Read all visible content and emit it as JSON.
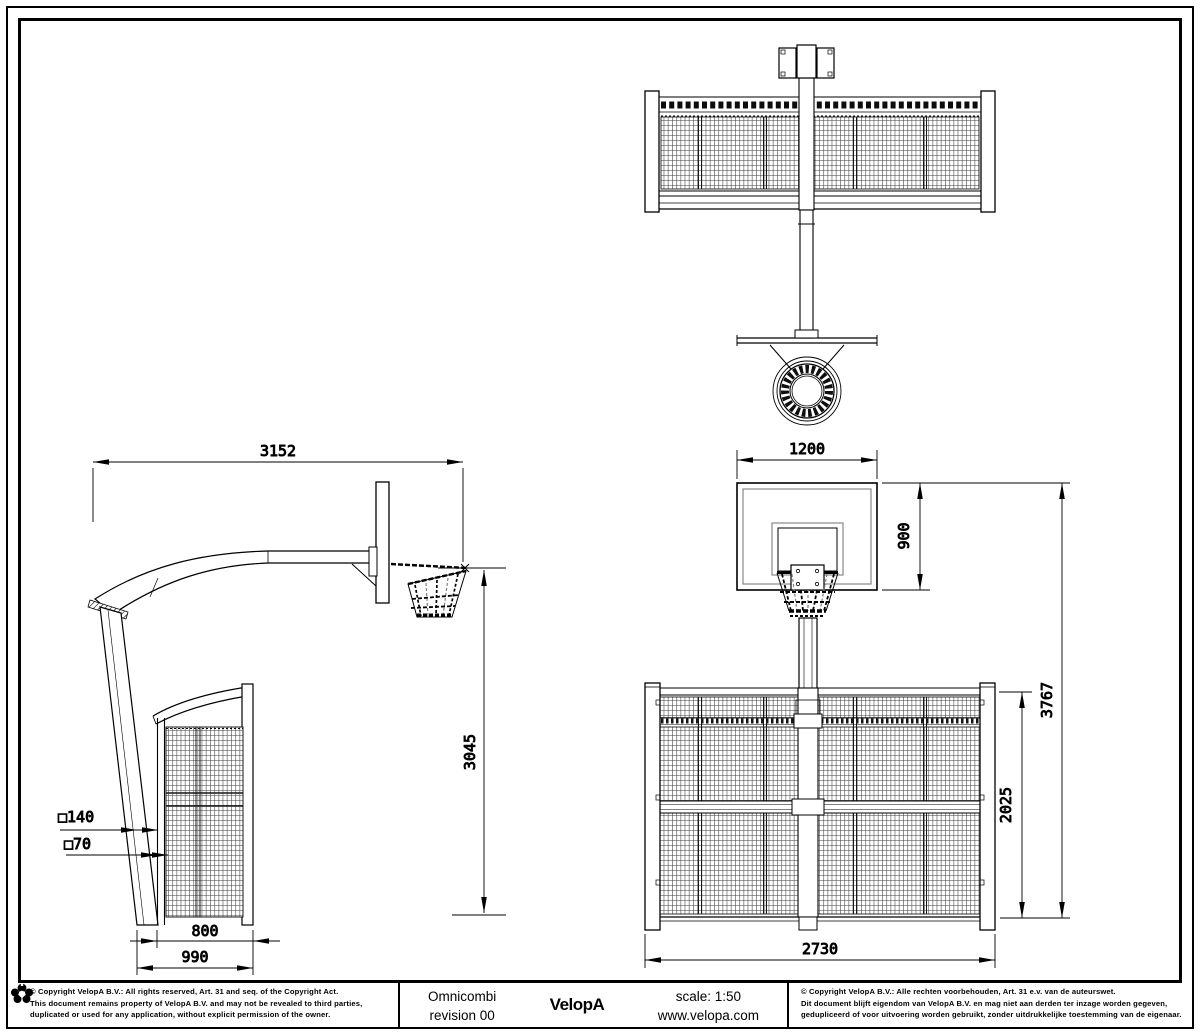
{
  "title_block": {
    "product": "Omnicombi",
    "revision": "revision 00",
    "brand": "VelopA",
    "scale": "scale: 1:50",
    "website": "www.velopa.com"
  },
  "copyright_en": {
    "line1": "© Copyright VelopA B.V.: All rights reserved, Art. 31 and seq. of the Copyright Act.",
    "line2": "This document remains property of VelopA B.V. and may not be revealed to third parties,",
    "line3": "duplicated or used for any application, without explicit permission of the owner."
  },
  "copyright_nl": {
    "line1": "© Copyright VelopA B.V.: Alle rechten voorbehouden, Art. 31 e.v. van de auteurswet.",
    "line2": "Dit document blijft eigendom van VelopA B.V. en mag niet aan derden ter inzage worden gegeven,",
    "line3": "gedupliceerd of voor uitvoering worden gebruikt, zonder uitdrukkelijke toestemming van de eigenaar."
  },
  "dimensions": {
    "arm_reach": "3152",
    "ring_height": "3045",
    "pole_section": "□140",
    "tube_section": "□70",
    "wall_depth": "800",
    "footprint_depth": "990",
    "backboard_width": "1200",
    "backboard_height": "900",
    "overall_height": "3767",
    "wall_height": "2025",
    "wall_width": "2730"
  },
  "colors": {
    "line": "#000000",
    "secondary_line": "#808080",
    "paper": "#ffffff"
  }
}
